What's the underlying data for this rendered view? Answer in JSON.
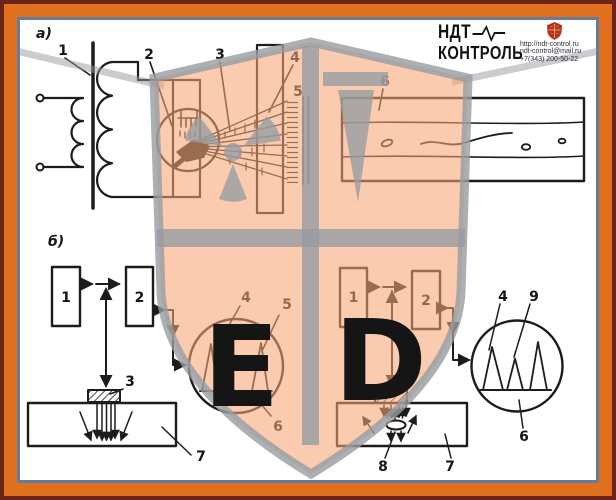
{
  "header": {
    "brand_line1": "НДТ",
    "brand_line2": "КОНТРОЛЬ",
    "website": "http://ndt-control.ru",
    "email": "ndt-control@mail.ru",
    "phone": "+7(343) 200-50-22"
  },
  "colors": {
    "frame_outer": "#6B2318",
    "frame_accent": "#E0701E",
    "frame_inner_line": "#5F7EA0",
    "canvas": "#FFFFFF",
    "ink": "#1C1C1C",
    "watermark_fill": "#F6A678",
    "watermark_gray": "#9EA3A8",
    "logo_shield_red": "#B5321F"
  },
  "diagram_a": {
    "label": "а)",
    "callout_transformer": "1",
    "callout_xray_tube": "2",
    "callout_radiation_beam": "3",
    "callout_test_object": "4",
    "callout_film": "5",
    "callout_radiograph": "6"
  },
  "diagram_b_left": {
    "label": "б)",
    "block_generator": "1",
    "block_receiver": "2",
    "callout_transducer": "3",
    "callout_initial_pulse": "4",
    "callout_bottom_echo": "5",
    "callout_screen": "6",
    "callout_test_piece": "7"
  },
  "diagram_b_right": {
    "block_generator": "1",
    "block_receiver": "2",
    "callout_transducer": "3",
    "callout_initial_pulse": "4",
    "callout_screen": "6",
    "callout_test_piece": "7",
    "callout_defect": "8",
    "callout_defect_echo": "9"
  },
  "watermark": {
    "quadrant_bl_glyph": "Е",
    "quadrant_br_glyph": "D"
  }
}
